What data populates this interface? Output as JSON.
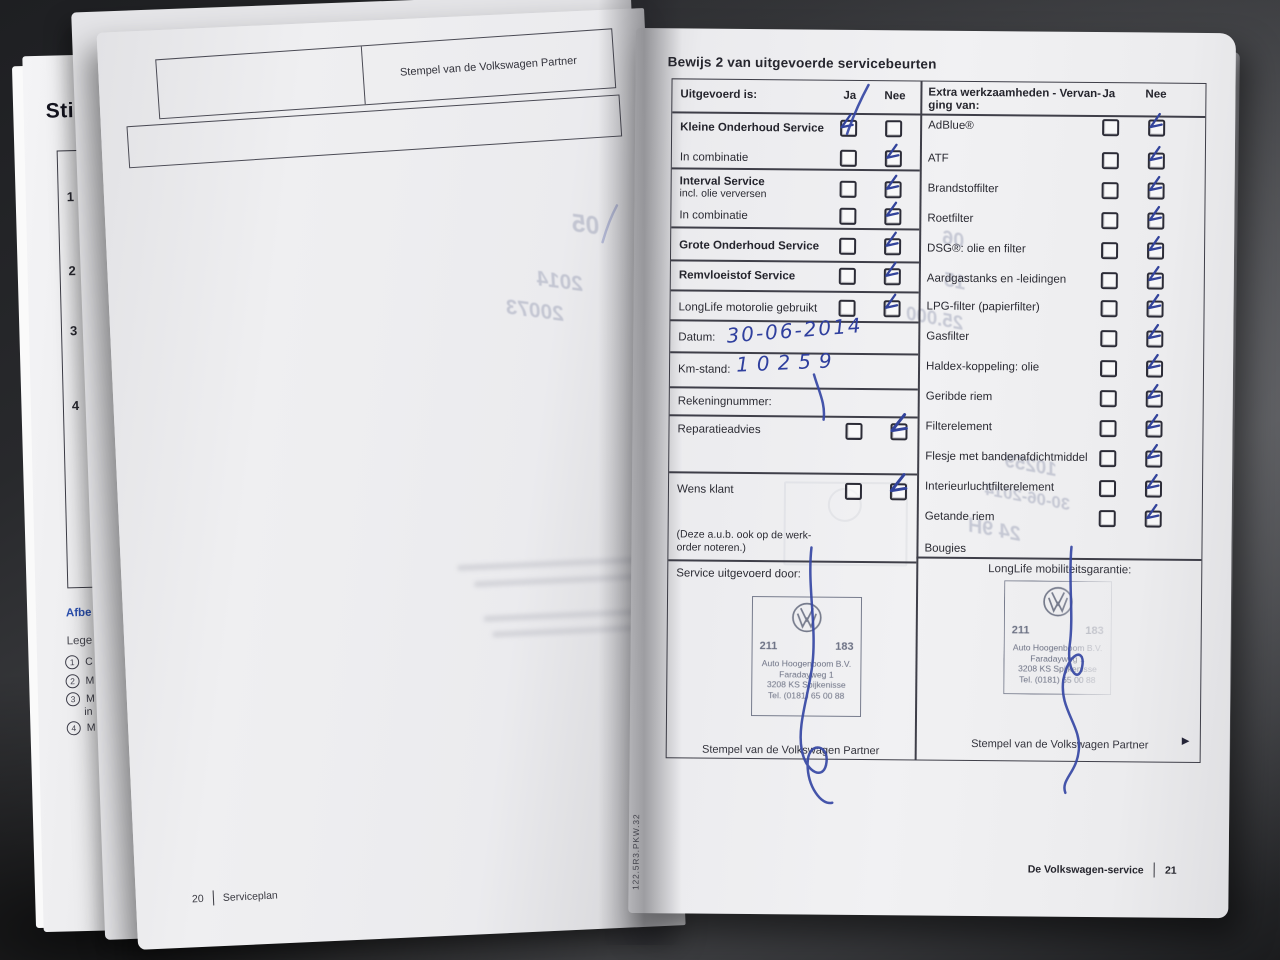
{
  "under_page": {
    "heading": "Sti",
    "row_numbers": [
      "1",
      "2",
      "3",
      "4"
    ],
    "caption1": "Afbe",
    "caption2": "Lege",
    "legend": [
      {
        "num": "1",
        "text": "C"
      },
      {
        "num": "2",
        "text": "M"
      },
      {
        "num": "3",
        "text": "M",
        "text2": "in"
      },
      {
        "num": "4",
        "text": "M"
      }
    ]
  },
  "left_page": {
    "stamp_box_label": "Stempel van de Volkswagen Partner",
    "footer_page": "20",
    "footer_label": "Serviceplan",
    "bleedthrough": [
      "05",
      "2014",
      "20073"
    ]
  },
  "right_page": {
    "title": "Bewijs 2 van uitgevoerde servicebeurten",
    "uitgevoerd": {
      "header": {
        "label": "Uitgevoerd is:",
        "ja": "Ja",
        "nee": "Nee"
      },
      "rows": [
        {
          "label": "Kleine Onderhoud Service",
          "ja_checked": true,
          "nee_checked": false
        },
        {
          "label": "In combinatie",
          "ja_checked": false,
          "nee_checked": true
        },
        {
          "label": "Interval Service",
          "sublabel": "incl. olie verversen",
          "ja_checked": false,
          "nee_checked": true
        },
        {
          "label": "In combinatie",
          "ja_checked": false,
          "nee_checked": true
        },
        {
          "label": "Grote Onderhoud Service",
          "ja_checked": false,
          "nee_checked": true
        },
        {
          "label": "Remvloeistof Service",
          "ja_checked": false,
          "nee_checked": true
        },
        {
          "label": "LongLife motorolie gebruikt",
          "ja_checked": false,
          "nee_checked": true
        }
      ],
      "fields": [
        {
          "label": "Datum:",
          "value": "30-06-2014"
        },
        {
          "label": "Km-stand:",
          "value": "10259"
        },
        {
          "label": "Rekeningnummer:",
          "value": ""
        }
      ],
      "extra_rows": [
        {
          "label": "Reparatieadvies",
          "ja_checked": false,
          "nee_checked": true
        },
        {
          "label": "Wens klant",
          "ja_checked": false,
          "nee_checked": true
        }
      ],
      "note_line1": "(Deze a.u.b. ook op de werk-",
      "note_line2": "order noteren.)",
      "service_by": "Service uitgevoerd door:",
      "stamp_caption": "Stempel van de Volkswagen Partner"
    },
    "extra": {
      "header_line1": "Extra werkzaamheden - Vervan-",
      "header_line2": "ging van:",
      "ja": "Ja",
      "nee": "Nee",
      "items": [
        "AdBlue®",
        "ATF",
        "Brandstoffilter",
        "Roetfilter",
        "DSG®: olie en filter",
        "Aardgastanks en -leidingen",
        "LPG-filter (papierfilter)",
        "Gasfilter",
        "Haldex-koppeling: olie",
        "Geribde riem",
        "Filterelement",
        "Flesje met bandenafdichtmiddel",
        "Interieurluchtfilterelement",
        "Getande riem",
        "Bougies"
      ],
      "items_nee_checked": [
        true,
        true,
        true,
        true,
        true,
        true,
        true,
        true,
        true,
        true,
        true,
        true,
        true,
        true,
        false
      ],
      "longlife_label": "LongLife mobiliteitsgarantie:",
      "stamp_caption": "Stempel van de Volkswagen Partner"
    },
    "stamp": {
      "number_left": "211",
      "number_right": "183",
      "line1": "Auto Hoogenboom B.V.",
      "line2": "Faradayweg 1",
      "line3": "3208 KS  Spijkenisse",
      "line4": "Tel. (0181) 65 00 88"
    },
    "handwriting": {
      "date": "30-06-2014",
      "km": "10259"
    },
    "bleedthrough": [
      "06",
      "15",
      "25.000",
      "10259",
      "30-06-2014",
      "24 9H"
    ],
    "spine_code": "122.5R3.PKW.32",
    "footer": {
      "label": "De Volkswagen-service",
      "page": "21"
    },
    "next_arrow": "▶"
  }
}
